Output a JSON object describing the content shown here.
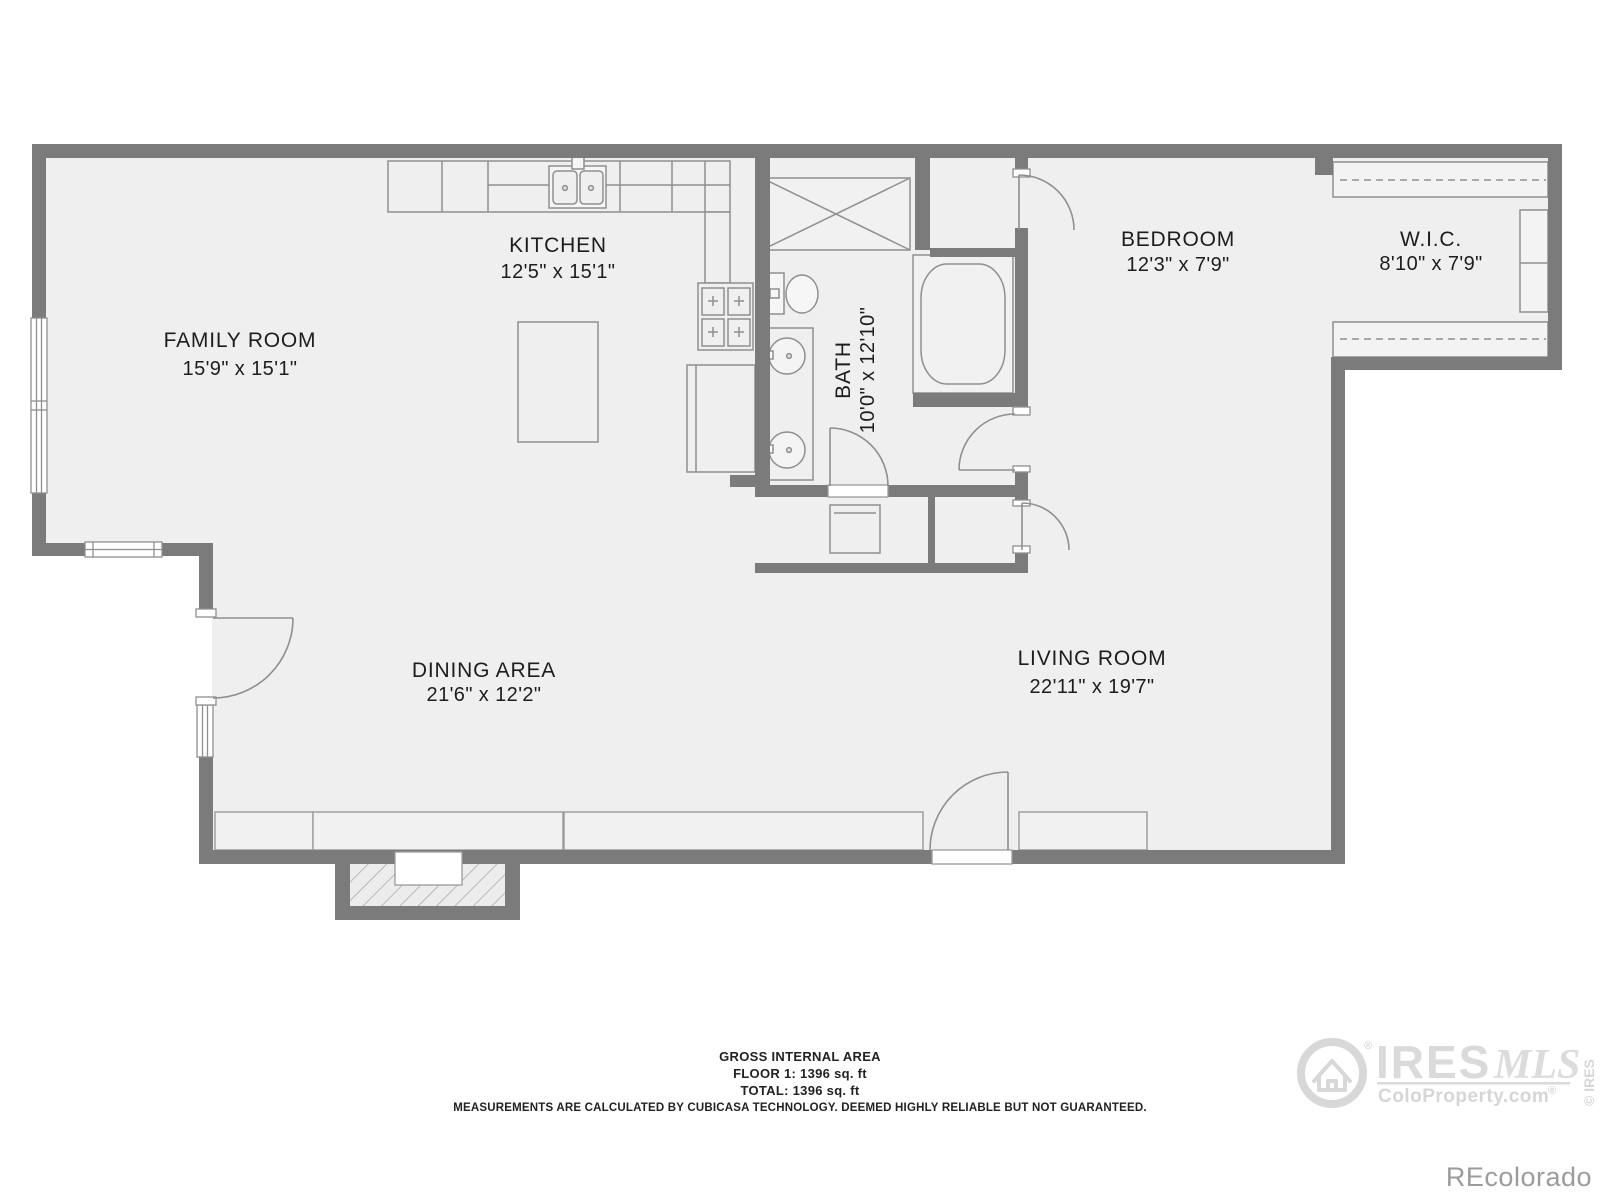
{
  "rooms": {
    "family": {
      "name": "FAMILY ROOM",
      "dims": "15'9\" x 15'1\""
    },
    "kitchen": {
      "name": "KITCHEN",
      "dims": "12'5\" x 15'1\""
    },
    "bath": {
      "name": "BATH",
      "dims": "10'0\" x 12'10\""
    },
    "bedroom": {
      "name": "BEDROOM",
      "dims": "12'3\" x 7'9\""
    },
    "wic": {
      "name": "W.I.C.",
      "dims": "8'10\" x 7'9\""
    },
    "living": {
      "name": "LIVING ROOM",
      "dims": "22'11\" x 19'7\""
    },
    "dining": {
      "name": "DINING AREA",
      "dims": "21'6\" x 12'2\""
    }
  },
  "footer": {
    "title": "GROSS INTERNAL AREA",
    "floor1": "FLOOR 1: 1396 sq. ft",
    "total": "TOTAL: 1396 sq. ft",
    "disclaimer": "MEASUREMENTS ARE CALCULATED BY CUBICASA TECHNOLOGY. DEEMED HIGHLY RELIABLE BUT NOT GUARANTEED."
  },
  "watermarks": {
    "ires": "IRES",
    "mls": "MLS",
    "registered": "®",
    "coloproperty": "ColoProperty.com",
    "copyright_vertical": "© IRES",
    "recolorado": "REcolorado"
  },
  "colors": {
    "wall": "#7b7b7b",
    "floor": "#efefef",
    "fixture_stroke": "#8f8f8f",
    "label": "#1d1d1d",
    "watermark_light": "#d9d9d9",
    "watermark_gray": "#9c9c9c"
  }
}
